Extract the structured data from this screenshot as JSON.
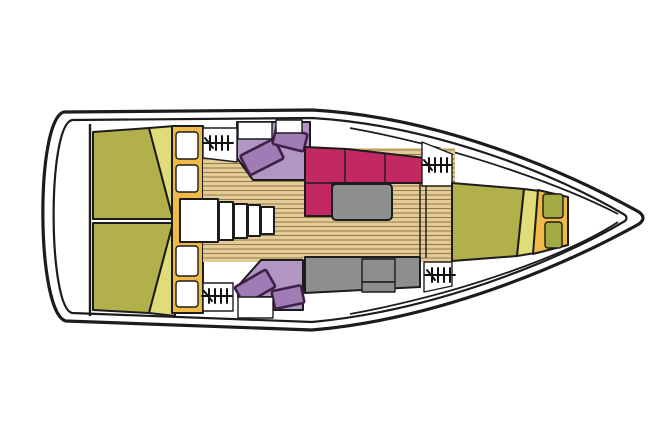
{
  "window": {
    "width": 667,
    "height": 446,
    "background": "#ffffff"
  },
  "diagram": {
    "kind": "sailboat-interior-deck-plan",
    "orientation": "bow-right",
    "colors": {
      "outline": "#1c1c1c",
      "hull_white": "#ffffff",
      "berth_olive": "#b2b04b",
      "berth_olive_light": "#e0dc79",
      "cabinet_orange": "#f0ba49",
      "shelf_olive": "#a3aa43",
      "floor_wood": "#e5cc97",
      "floor_plank": "#8f7a4b",
      "settee_magenta": "#c12960",
      "seat_purple": "#b195c3",
      "cushion_purple": "#a07cb4",
      "cushion_outline": "#3f2148",
      "counter_gray": "#8e8e8e",
      "white": "#ffffff"
    },
    "regions": [
      "hull",
      "aft-cabin-port-berth",
      "aft-cabin-starboard-berth",
      "locker-column",
      "companionway-steps",
      "saloon-floor",
      "nav-seat-port",
      "nav-seat-starboard",
      "saloon-settee",
      "saloon-table",
      "galley-counter",
      "v-berth",
      "bow-shelves"
    ],
    "icons": [
      {
        "name": "hanging-locker-icon",
        "glyph": "rail-with-hangers",
        "count": 4
      }
    ]
  }
}
